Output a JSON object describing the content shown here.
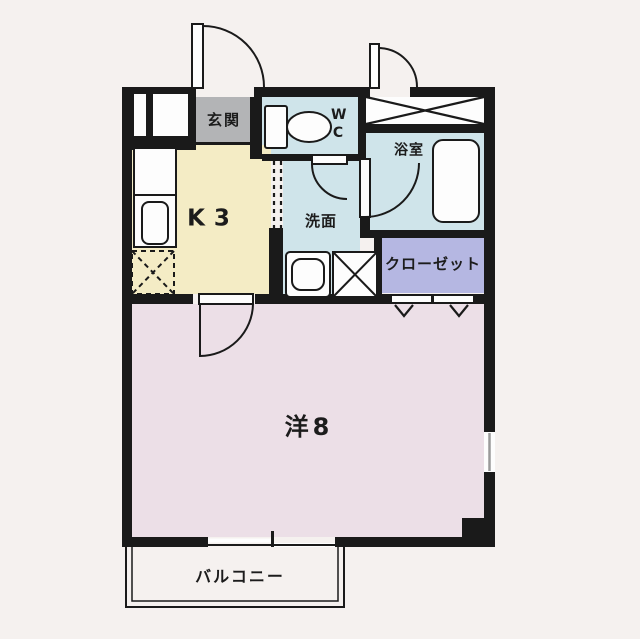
{
  "floorplan": {
    "rooms": {
      "genkan": {
        "label": "玄関"
      },
      "wc": {
        "label": "WC"
      },
      "bath": {
        "label": "浴室"
      },
      "kitchen": {
        "label": "K3"
      },
      "washroom": {
        "label": "洗面"
      },
      "closet": {
        "label": "クローゼット"
      },
      "main_room": {
        "label": "洋8"
      },
      "balcony": {
        "label": "バルコニー"
      }
    },
    "colors": {
      "background": "#f5f1ef",
      "wall": "#1a1a1a",
      "genkan": "#b3b4b6",
      "wet_area": "#cfe4ea",
      "kitchen": "#f4ecc5",
      "closet": "#b5b7e2",
      "main_room": "#ecdfe7",
      "fixture": "#fdfdfd",
      "window_glass": "#9a9a9a"
    }
  }
}
